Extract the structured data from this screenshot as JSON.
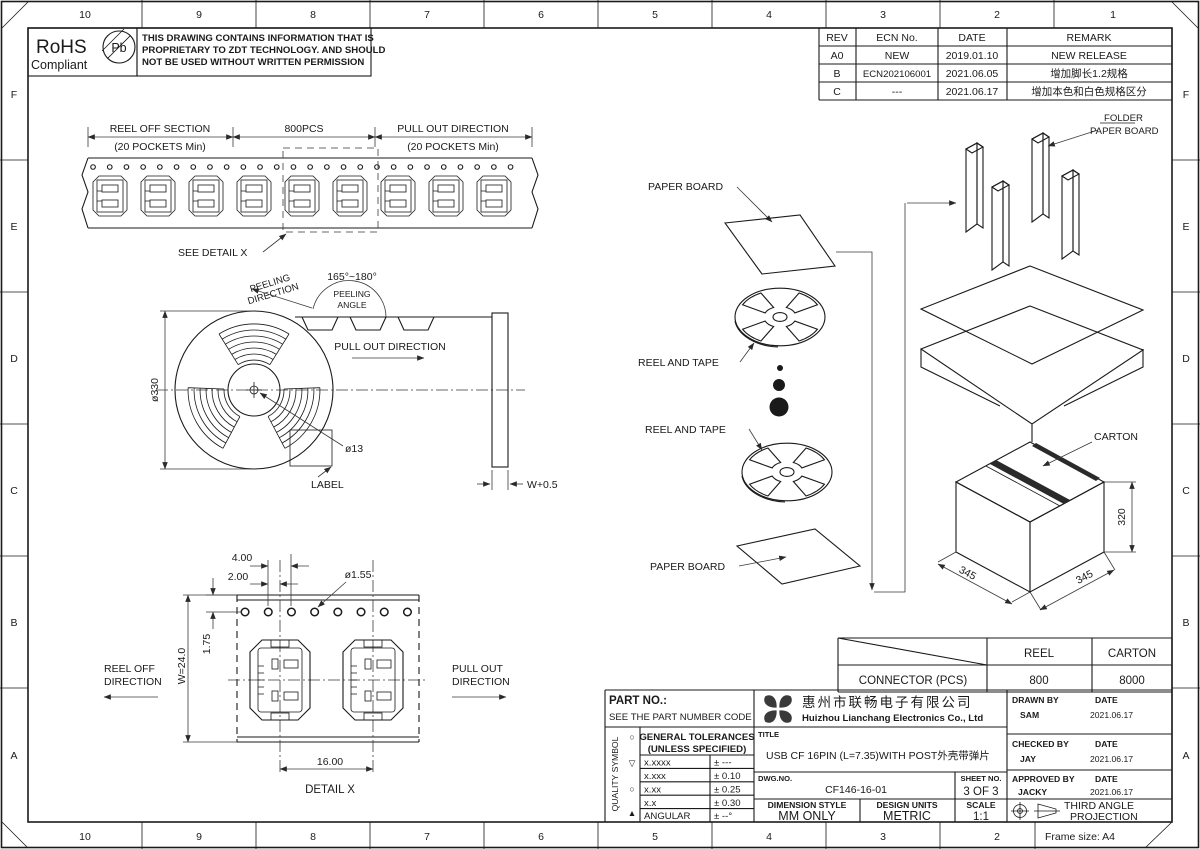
{
  "frame": {
    "columns": [
      "10",
      "9",
      "8",
      "7",
      "6",
      "5",
      "4",
      "3",
      "2",
      "1"
    ],
    "rows": [
      "F",
      "E",
      "D",
      "C",
      "B",
      "A"
    ],
    "frame_size_label": "Frame size: A4"
  },
  "header": {
    "rohs_line1": "RoHS",
    "rohs_line2": "Compliant",
    "pb_symbol": "Pb",
    "notice_line1": "THIS DRAWING CONTAINS INFORMATION THAT IS",
    "notice_line2": "PROPRIETARY TO ZDT TECHNOLOGY. AND SHOULD",
    "notice_line3": "NOT BE USED WITHOUT WRITTEN PERMISSION"
  },
  "revision_table": {
    "headers": [
      "REV",
      "ECN No.",
      "DATE",
      "REMARK"
    ],
    "rows": [
      {
        "rev": "A0",
        "ecn": "NEW",
        "date": "2019.01.10",
        "remark": "NEW RELEASE"
      },
      {
        "rev": "B",
        "ecn": "ECN202106001",
        "date": "2021.06.05",
        "remark": "增加脚长1.2规格"
      },
      {
        "rev": "C",
        "ecn": "---",
        "date": "2021.06.17",
        "remark": "增加本色和白色规格区分"
      }
    ]
  },
  "tape_view": {
    "reel_off_label": "REEL OFF SECTION",
    "reel_off_sub": "(20 POCKETS Min)",
    "qty_label": "800PCS",
    "pull_out_label": "PULL OUT DIRECTION",
    "pull_out_sub": "(20 POCKETS Min)",
    "see_detail_label": "SEE DETAIL X"
  },
  "reel_view": {
    "peeling_angle_range": "165°~180°",
    "peeling_dir_1": "PEELING",
    "peeling_dir_2": "DIRECTION",
    "peeling_angle_1": "PEELING",
    "peeling_angle_2": "ANGLE",
    "pull_out_label": "PULL OUT DIRECTION",
    "reel_diameter": "ø330",
    "hub_diameter": "ø13",
    "label_text": "LABEL",
    "width_label": "W+0.5"
  },
  "packing_view": {
    "paper_board_top": "PAPER BOARD",
    "reel_and_tape_1": "REEL AND TAPE",
    "reel_and_tape_2": "REEL AND TAPE",
    "paper_board_bottom": "PAPER BOARD",
    "folder_label_1": "FOLDER",
    "folder_label_2": "PAPER BOARD",
    "carton_label": "CARTON",
    "dim_left": "345",
    "dim_right": "345",
    "dim_height": "320"
  },
  "detail_view": {
    "dim_pitch": "4.00",
    "dim_offset": "2.00",
    "dim_hole": "ø1.55",
    "dim_edge": "1.75",
    "dim_width": "W=24.0",
    "dim_span": "16.00",
    "reel_off_1": "REEL OFF",
    "reel_off_2": "DIRECTION",
    "pull_out_1": "PULL OUT",
    "pull_out_2": "DIRECTION",
    "caption": "DETAIL X"
  },
  "qty_table": {
    "col_reel": "REEL",
    "col_carton": "CARTON",
    "row_label": "CONNECTOR (PCS)",
    "reel_qty": "800",
    "carton_qty": "8000"
  },
  "title_block": {
    "part_no_label": "PART NO.:",
    "part_no_value": "SEE THE PART NUMBER CODE",
    "quality_symbol_label": "QUALITY SYMBOL",
    "quality_symbols": [
      "○",
      "▽",
      "○",
      "▲"
    ],
    "tolerances_title1": "GENERAL TOLERANCES",
    "tolerances_title2": "(UNLESS SPECIFIED)",
    "tolerances": [
      {
        "range": "x.xxxx",
        "value": "± ---"
      },
      {
        "range": "x.xxx",
        "value": "± 0.10"
      },
      {
        "range": "x.xx",
        "value": "± 0.25"
      },
      {
        "range": "x.x",
        "value": "± 0.30"
      },
      {
        "range": "ANGULAR",
        "value": "± --°"
      }
    ],
    "company_cn": "惠州市联畅电子有限公司",
    "company_en": "Huizhou Lianchang Electronics Co., Ltd",
    "title_label": "TITLE",
    "title_value": "USB CF 16PIN (L=7.35)WITH POST外壳带弹片",
    "dwg_no_label": "DWG.NO.",
    "dwg_no_value": "CF146-16-01",
    "sheet_no_label": "SHEET NO.",
    "sheet_no_value": "3 OF 3",
    "dimension_style_label": "DIMENSION STYLE",
    "dimension_style_value": "MM ONLY",
    "design_units_label": "DESIGN UNITS",
    "design_units_value": "METRIC",
    "scale_label": "SCALE",
    "scale_value": "1:1",
    "drawn_by_label": "DRAWN BY",
    "drawn_by_value": "SAM",
    "checked_by_label": "CHECKED BY",
    "checked_by_value": "JAY",
    "approved_by_label": "APPROVED BY",
    "approved_by_value": "JACKY",
    "date_label": "DATE",
    "drawn_date": "2021.06.17",
    "checked_date": "2021.06.17",
    "approved_date": "2021.06.17",
    "projection_line1": "THIRD ANGLE",
    "projection_line2": "PROJECTION"
  }
}
